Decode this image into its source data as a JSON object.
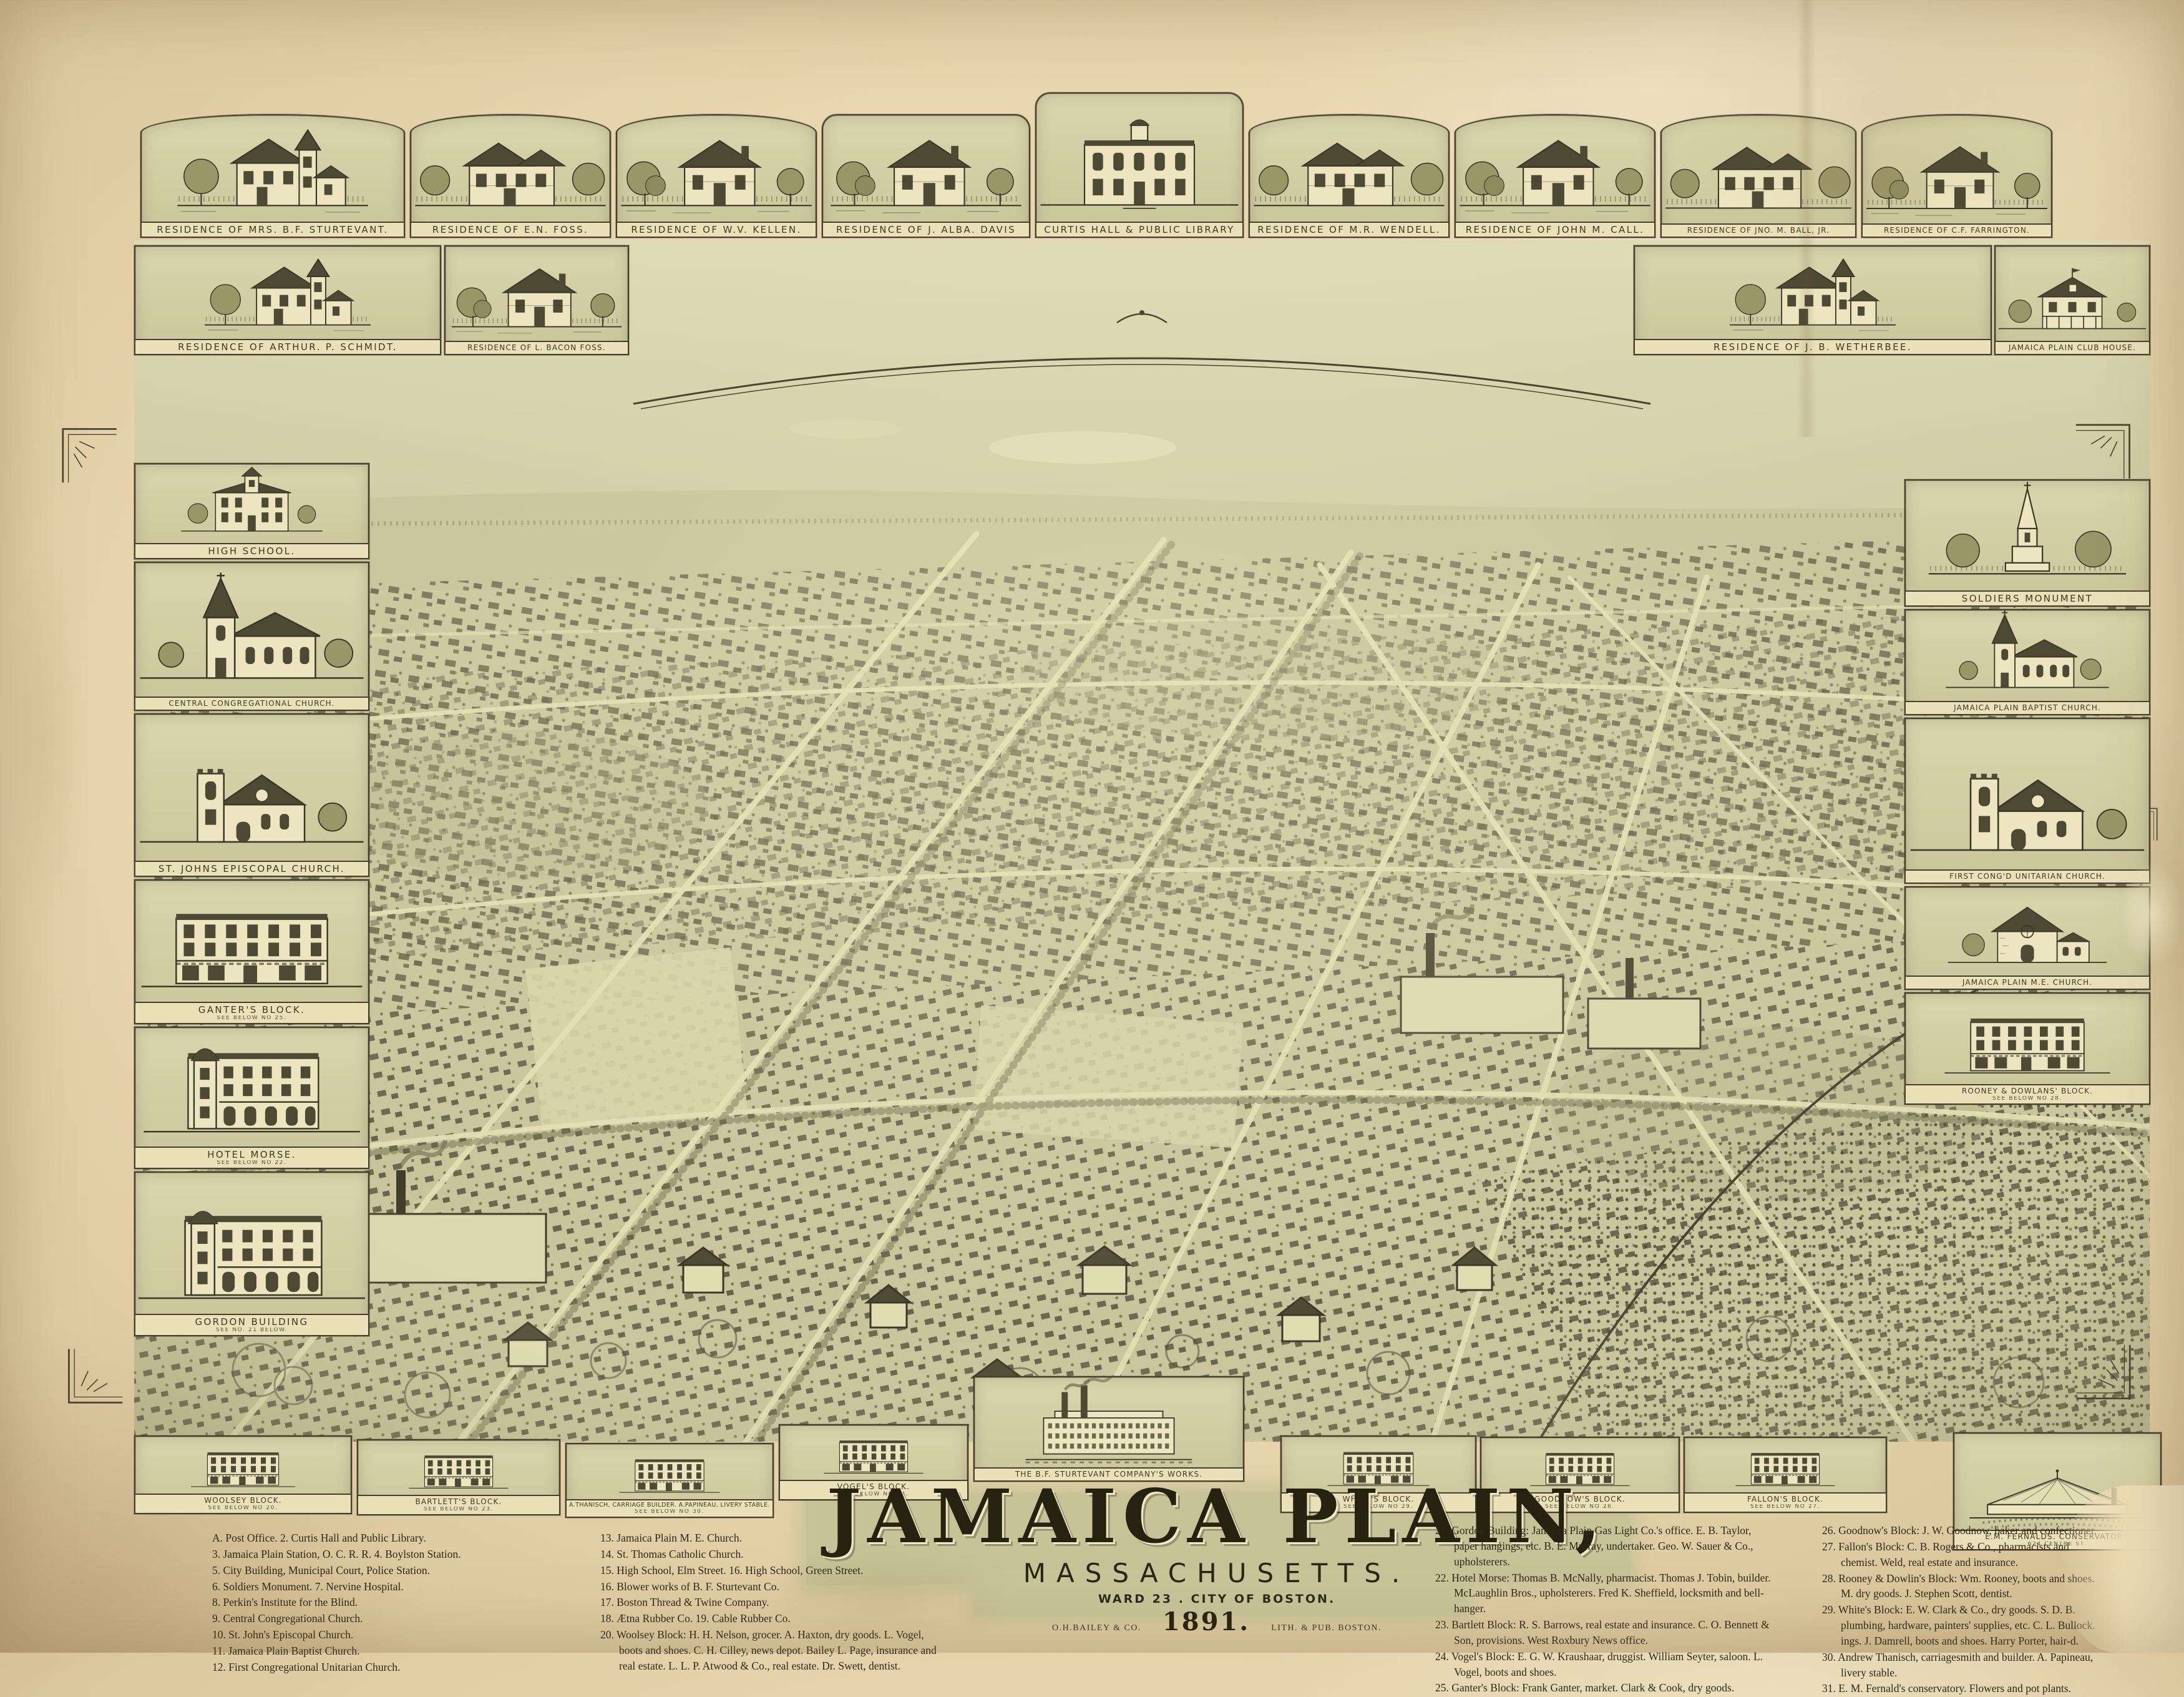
{
  "palette": {
    "paper": "#e8d6af",
    "map_tone": "#c9c49c",
    "ink": "#3b3726",
    "caption_bg": "#eae1b9",
    "title_band": "#c7c298"
  },
  "title": {
    "main": "JAMAICA PLAIN,",
    "state": "MASSACHUSETTS.",
    "ward": "WARD 23 . CITY OF BOSTON.",
    "publisher_left": "O.H.BAILEY & CO.",
    "year": "1891.",
    "publisher_right": "LITH. & PUB. BOSTON."
  },
  "vignettes": {
    "top_row": [
      {
        "caption": "RESIDENCE OF MRS. B.F. STURTEVANT."
      },
      {
        "caption": "RESIDENCE OF E.N. FOSS."
      },
      {
        "caption": "RESIDENCE OF W.V. KELLEN."
      },
      {
        "caption": "RESIDENCE OF J. ALBA. DAVIS"
      },
      {
        "caption": "CURTIS HALL & PUBLIC LIBRARY"
      },
      {
        "caption": "RESIDENCE OF M.R. WENDELL."
      },
      {
        "caption": "RESIDENCE OF JOHN M. CALL."
      },
      {
        "caption": "RESIDENCE OF JNO. M. BALL, JR."
      },
      {
        "caption": "RESIDENCE OF C.F. FARRINGTON."
      }
    ],
    "second_row": [
      {
        "caption": "RESIDENCE OF ARTHUR. P. SCHMIDT."
      },
      {
        "caption": "RESIDENCE OF L. BACON FOSS."
      },
      {
        "caption": "RESIDENCE OF J. B. WETHERBEE."
      },
      {
        "caption": "JAMAICA PLAIN CLUB HOUSE."
      }
    ],
    "left_column": [
      {
        "caption": "HIGH SCHOOL."
      },
      {
        "caption": "CENTRAL CONGREGATIONAL CHURCH."
      },
      {
        "caption": "ST. JOHNS EPISCOPAL CHURCH."
      },
      {
        "caption": "GANTER'S BLOCK.",
        "sub": "SEE BELOW NO 25."
      },
      {
        "caption": "HOTEL MORSE.",
        "sub": "SEE BELOW NO 22."
      },
      {
        "caption": "GORDON BUILDING",
        "sub": "SEE NO. 21 BELOW."
      }
    ],
    "right_column": [
      {
        "caption": "SOLDIERS MONUMENT"
      },
      {
        "caption": "JAMAICA PLAIN BAPTIST CHURCH."
      },
      {
        "caption": "FIRST CONG'D UNITARIAN CHURCH."
      },
      {
        "caption": "JAMAICA PLAIN M.E. CHURCH."
      },
      {
        "caption": "ROONEY & DOWLANS' BLOCK.",
        "sub": "SEE BELOW NO 28."
      }
    ],
    "bottom_row": [
      {
        "caption": "WOOLSEY BLOCK.",
        "sub": "SEE BELOW NO 20."
      },
      {
        "caption": "BARTLETT'S BLOCK.",
        "sub": "SEE BELOW NO 23."
      },
      {
        "caption": "A.THANISCH, CARRIAGE BUILDER. A.PAPINEAU, LIVERY STABLE.",
        "sub": "SEE BELOW NO 30."
      },
      {
        "caption": "VOGEL'S BLOCK.",
        "sub": "SEE BELOW NO 24."
      },
      {
        "caption": "THE B.F. STURTEVANT COMPANY'S WORKS."
      },
      {
        "caption": "WHITE'S BLOCK.",
        "sub": "SEE BELOW NO 29."
      },
      {
        "caption": "GOODNOW'S BLOCK.",
        "sub": "SEE BELOW NO 26."
      },
      {
        "caption": "FALLON'S BLOCK.",
        "sub": "SEE BELOW NO 27."
      },
      {
        "caption": "E.M. FERNALDS. CONSERVATORY.",
        "sub": "624 CENTRE ST."
      }
    ]
  },
  "legend": {
    "columns": [
      {
        "entries": [
          "A.  Post Office.   2.  Curtis Hall and Public Library.",
          "3.  Jamaica Plain Station, O. C. R. R.   4.  Boylston Station.",
          "5.  City Building, Municipal Court, Police Station.",
          "6.  Soldiers Monument.   7.  Nervine Hospital.",
          "8.  Perkin's Institute for the Blind.",
          "9.  Central Congregational Church.",
          "10.  St. John's Episcopal Church.",
          "11.  Jamaica Plain Baptist Church.",
          "12.  First Congregational Unitarian Church."
        ]
      },
      {
        "entries": [
          "13.  Jamaica Plain M. E. Church.",
          "14.  St. Thomas Catholic Church.",
          "15.  High School, Elm Street.   16.  High School, Green Street.",
          "16.  Blower works of B. F. Sturtevant Co.",
          "17.  Boston Thread & Twine Company.",
          "18.  Ætna Rubber Co.   19.  Cable Rubber Co.",
          "20.  Woolsey Block:  H. H. Nelson, grocer.  A. Haxton, dry goods.  L. Vogel, boots and shoes.  C. H. Cilley, news depot.  Bailey L. Page, insurance and real estate.  L. L. P. Atwood & Co., real estate.  Dr. Swett, dentist."
        ]
      },
      {
        "entries": [
          "21.  Gordon Building:  Jamaica Plain Gas Light Co.'s office.  E. B. Taylor, paper hangings, etc.  B. E. Murray, undertaker.  Geo. W. Sauer & Co., upholsterers.",
          "22.  Hotel Morse:  Thomas B. McNally, pharmacist.  Thomas J. Tobin, builder.  McLaughlin Bros., upholsterers.  Fred K. Sheffield, locksmith and bell-hanger.",
          "23.  Bartlett Block:  R. S. Barrows, real estate and insurance.  C. O. Bennett & Son, provisions.  West Roxbury News office.",
          "24.  Vogel's Block:  E. G. W. Kraushaar, druggist.  William Seyter, saloon.  L. Vogel, boots and shoes.",
          "25.  Ganter's Block:  Frank Ganter, market.  Clark & Cook, dry goods."
        ]
      },
      {
        "entries": [
          "26.  Goodnow's Block:  J. W. Goodnow, baker and confectioner.",
          "27.  Fallon's Block:  C. B. Rogers & Co., pharmacists and chemist. Weld, real estate and insurance.",
          "28.  Rooney & Dowlin's Block:  Wm. Rooney, boots and shoes.  M. dry goods.  J. Stephen Scott, dentist.",
          "29.  White's Block:  E. W. Clark & Co., dry goods.  S. D. B. plumbing, hardware, painters' supplies, etc.  C. L. Bullock. ings.  J. Damrell, boots and shoes.  Harry Porter, hair-d.",
          "30.  Andrew Thanisch, carriagesmith and builder.  A. Papineau, livery stable.",
          "31.  E. M. Fernald's conservatory.  Flowers and pot plants."
        ]
      }
    ]
  }
}
